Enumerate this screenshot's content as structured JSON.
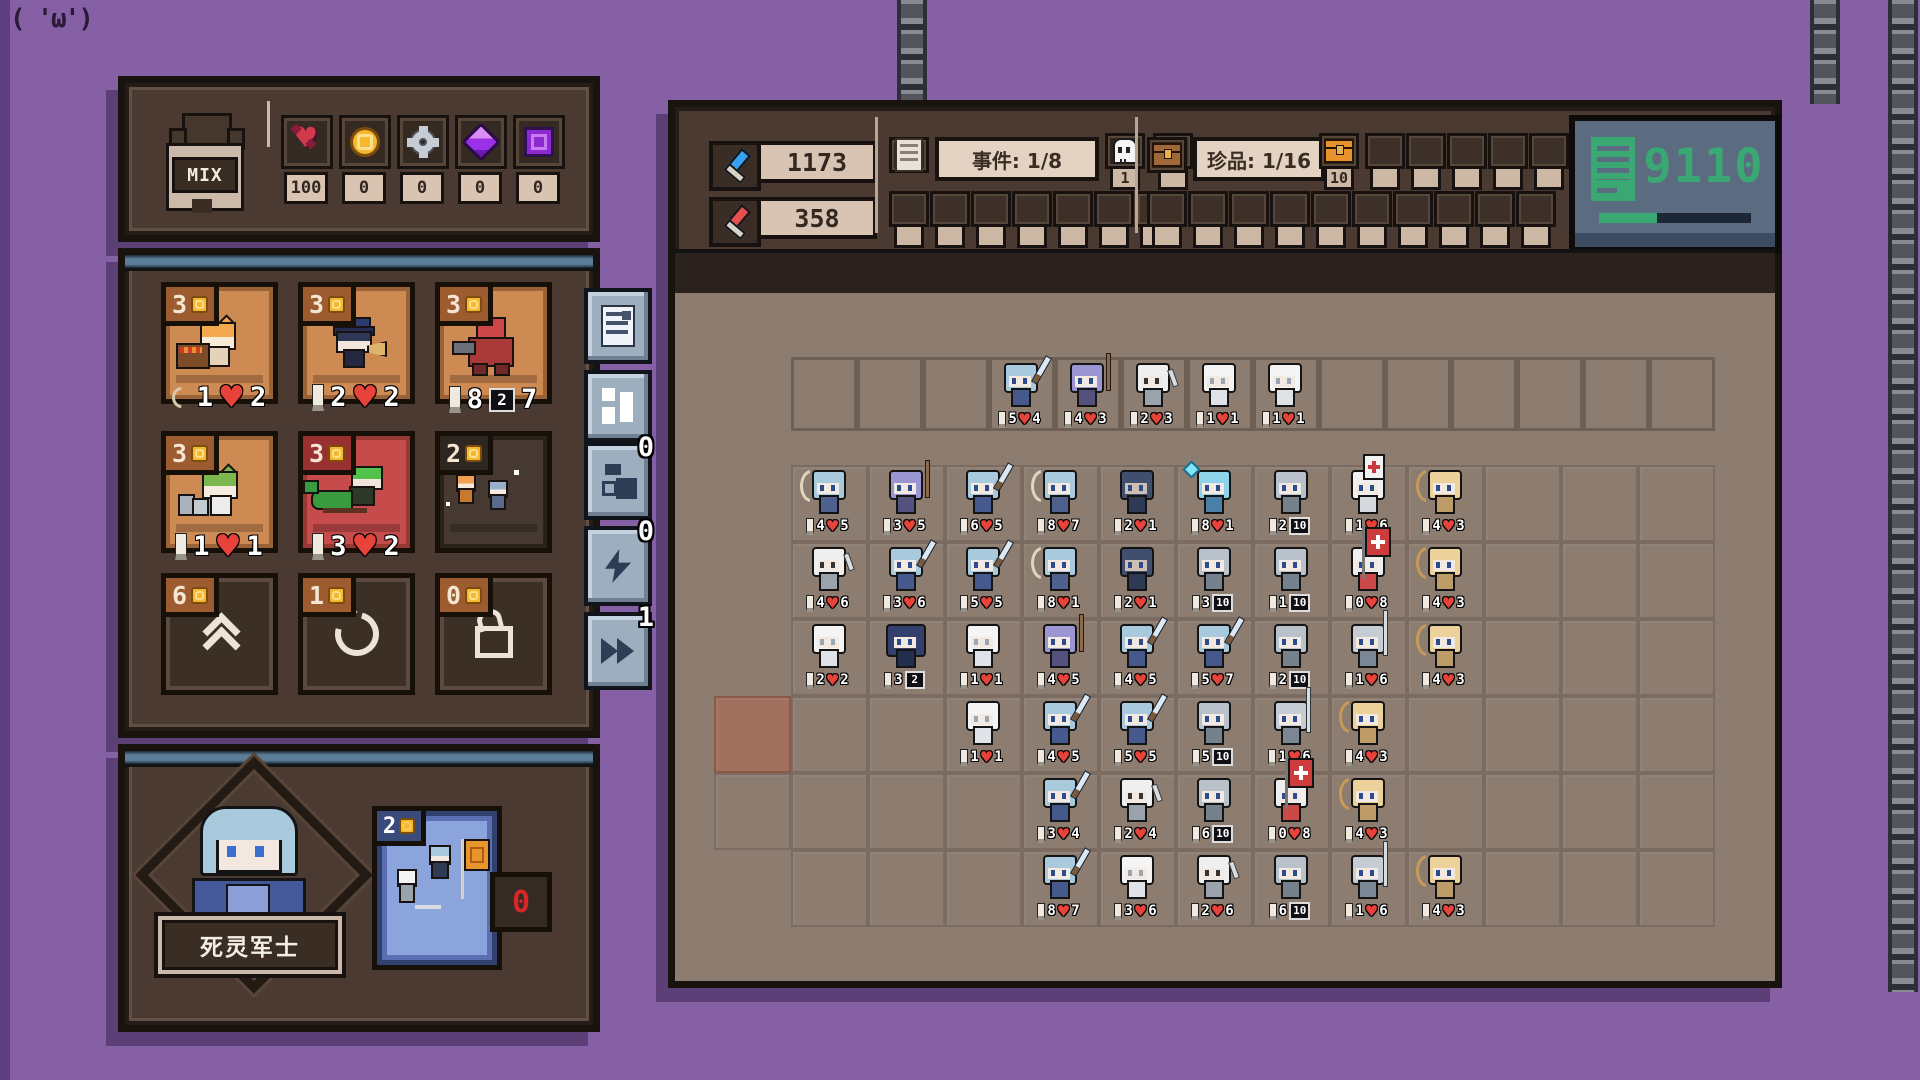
{
  "decoration": {
    "kaomoji": "( 'ω')"
  },
  "left_panel": {
    "base_label": "MIX",
    "currencies": [
      {
        "icon": "demon-heart",
        "value": "100"
      },
      {
        "icon": "coin",
        "value": "0"
      },
      {
        "icon": "gear",
        "value": "0"
      },
      {
        "icon": "gem",
        "value": "0"
      },
      {
        "icon": "cube",
        "value": "0"
      }
    ],
    "shop": {
      "cards": [
        {
          "cost": "3",
          "sprite": "orange-cat-shopkeeper",
          "stats": [
            [
              "bow",
              "1"
            ],
            [
              "heart",
              "2"
            ]
          ]
        },
        {
          "cost": "3",
          "sprite": "police-girl",
          "stats": [
            [
              "candle",
              "2"
            ],
            [
              "heart",
              "2"
            ]
          ]
        },
        {
          "cost": "3",
          "sprite": "red-mech",
          "stats": [
            [
              "candle",
              "8"
            ],
            [
              "shield",
              "2"
            ],
            [
              "plain",
              "7"
            ]
          ]
        },
        {
          "cost": "3",
          "sprite": "green-cat-girl",
          "stats": [
            [
              "candle",
              "1"
            ],
            [
              "heart",
              "1"
            ]
          ]
        },
        {
          "cost": "3",
          "sprite": "dragon-girl",
          "stats": [
            [
              "candle",
              "3"
            ],
            [
              "heart",
              "2"
            ]
          ]
        },
        {
          "cost": "2",
          "sprite": "duo-unit",
          "stats": []
        }
      ],
      "buttons": [
        {
          "cost": "6",
          "icon": "upgrade"
        },
        {
          "cost": "1",
          "icon": "refresh"
        },
        {
          "cost": "0",
          "icon": "lock"
        }
      ]
    },
    "hero": {
      "name": "死灵军士",
      "skill_cost": "2",
      "skill_counter": "0"
    }
  },
  "side_buttons": [
    {
      "icon": "document",
      "badge": ""
    },
    {
      "icon": "grid",
      "badge": ""
    },
    {
      "icon": "squares",
      "badge": "0"
    },
    {
      "icon": "lightning",
      "badge": "0"
    },
    {
      "icon": "fast-forward",
      "badge": "1"
    }
  ],
  "right_panel": {
    "blue_power": "1173",
    "red_power": "358",
    "events_label": "事件: 1/8",
    "skull_count": "1",
    "event_top_empty": 1,
    "event_bottom_slots": 7,
    "treasure_label": "珍品: 1/16",
    "chest_count": "10",
    "treasure_top_slots": 6,
    "treasure_bottom_slots": 10,
    "counter": {
      "value": "9110",
      "progress": 38
    }
  },
  "battle": {
    "grid": {
      "rows": 6,
      "cols": 12,
      "enemy_cells": 14
    },
    "extra_cells": [
      {
        "r": 3,
        "c": -1,
        "hl": true
      },
      {
        "r": 4,
        "c": -1,
        "hl": false
      }
    ],
    "enemy_units": [
      {
        "t": "blue",
        "s": [
          [
            "a",
            "5"
          ],
          [
            "h",
            "4"
          ]
        ]
      },
      {
        "t": "purple",
        "s": [
          [
            "a",
            "4"
          ],
          [
            "h",
            "3"
          ]
        ]
      },
      {
        "t": "skel",
        "s": [
          [
            "a",
            "2"
          ],
          [
            "h",
            "3"
          ]
        ]
      },
      {
        "t": "ghost",
        "s": [
          [
            "a",
            "1"
          ],
          [
            "h",
            "1"
          ]
        ]
      },
      {
        "t": "ghost",
        "s": [
          [
            "a",
            "1"
          ],
          [
            "h",
            "1"
          ]
        ]
      }
    ],
    "units": [
      {
        "r": 0,
        "c": 0,
        "t": "bluearcher",
        "s": [
          [
            "a",
            "4"
          ],
          [
            "h",
            "5"
          ]
        ]
      },
      {
        "r": 0,
        "c": 1,
        "t": "purple",
        "s": [
          [
            "a",
            "3"
          ],
          [
            "h",
            "5"
          ]
        ]
      },
      {
        "r": 0,
        "c": 2,
        "t": "blue",
        "s": [
          [
            "a",
            "6"
          ],
          [
            "h",
            "5"
          ]
        ]
      },
      {
        "r": 0,
        "c": 3,
        "t": "bluearcher",
        "s": [
          [
            "a",
            "8"
          ],
          [
            "h",
            "7"
          ]
        ]
      },
      {
        "r": 0,
        "c": 4,
        "t": "hood",
        "s": [
          [
            "a",
            "2"
          ],
          [
            "h",
            "1"
          ]
        ]
      },
      {
        "r": 0,
        "c": 5,
        "t": "ice",
        "s": [
          [
            "a",
            "8"
          ],
          [
            "h",
            "1"
          ]
        ]
      },
      {
        "r": 0,
        "c": 6,
        "t": "knight",
        "s": [
          [
            "a",
            "2"
          ],
          [
            "s",
            "10"
          ]
        ]
      },
      {
        "r": 0,
        "c": 7,
        "t": "medic",
        "s": [
          [
            "a",
            "1"
          ],
          [
            "h",
            "6"
          ]
        ]
      },
      {
        "r": 0,
        "c": 8,
        "t": "tan",
        "s": [
          [
            "a",
            "4"
          ],
          [
            "h",
            "3"
          ]
        ]
      },
      {
        "r": 1,
        "c": 0,
        "t": "skel",
        "s": [
          [
            "a",
            "4"
          ],
          [
            "h",
            "6"
          ]
        ]
      },
      {
        "r": 1,
        "c": 1,
        "t": "blue",
        "s": [
          [
            "a",
            "3"
          ],
          [
            "h",
            "6"
          ]
        ]
      },
      {
        "r": 1,
        "c": 2,
        "t": "blue",
        "s": [
          [
            "a",
            "5"
          ],
          [
            "h",
            "5"
          ]
        ]
      },
      {
        "r": 1,
        "c": 3,
        "t": "bluearcher",
        "s": [
          [
            "a",
            "8"
          ],
          [
            "h",
            "1"
          ]
        ]
      },
      {
        "r": 1,
        "c": 4,
        "t": "hood",
        "s": [
          [
            "a",
            "2"
          ],
          [
            "h",
            "1"
          ]
        ]
      },
      {
        "r": 1,
        "c": 5,
        "t": "knight",
        "s": [
          [
            "a",
            "3"
          ],
          [
            "s",
            "10"
          ]
        ]
      },
      {
        "r": 1,
        "c": 6,
        "t": "knight",
        "s": [
          [
            "a",
            "1"
          ],
          [
            "s",
            "10"
          ]
        ]
      },
      {
        "r": 1,
        "c": 7,
        "t": "banner",
        "s": [
          [
            "a",
            "0"
          ],
          [
            "h",
            "8"
          ]
        ]
      },
      {
        "r": 1,
        "c": 8,
        "t": "tan",
        "s": [
          [
            "a",
            "4"
          ],
          [
            "h",
            "3"
          ]
        ]
      },
      {
        "r": 2,
        "c": 0,
        "t": "ghost",
        "s": [
          [
            "a",
            "2"
          ],
          [
            "h",
            "2"
          ]
        ]
      },
      {
        "r": 2,
        "c": 1,
        "t": "bigknight",
        "s": [
          [
            "a",
            "3"
          ],
          [
            "s",
            "2"
          ]
        ]
      },
      {
        "r": 2,
        "c": 2,
        "t": "ghost",
        "s": [
          [
            "a",
            "1"
          ],
          [
            "h",
            "1"
          ]
        ]
      },
      {
        "r": 2,
        "c": 3,
        "t": "purple",
        "s": [
          [
            "a",
            "4"
          ],
          [
            "h",
            "5"
          ]
        ]
      },
      {
        "r": 2,
        "c": 4,
        "t": "blue",
        "s": [
          [
            "a",
            "4"
          ],
          [
            "h",
            "5"
          ]
        ]
      },
      {
        "r": 2,
        "c": 5,
        "t": "blue",
        "s": [
          [
            "a",
            "5"
          ],
          [
            "h",
            "7"
          ]
        ]
      },
      {
        "r": 2,
        "c": 6,
        "t": "knight",
        "s": [
          [
            "a",
            "2"
          ],
          [
            "s",
            "10"
          ]
        ]
      },
      {
        "r": 2,
        "c": 7,
        "t": "spear",
        "s": [
          [
            "a",
            "1"
          ],
          [
            "h",
            "6"
          ]
        ]
      },
      {
        "r": 2,
        "c": 8,
        "t": "tan",
        "s": [
          [
            "a",
            "4"
          ],
          [
            "h",
            "3"
          ]
        ]
      },
      {
        "r": 3,
        "c": 2,
        "t": "ghost",
        "s": [
          [
            "a",
            "1"
          ],
          [
            "h",
            "1"
          ]
        ]
      },
      {
        "r": 3,
        "c": 3,
        "t": "blue",
        "s": [
          [
            "a",
            "4"
          ],
          [
            "h",
            "5"
          ]
        ]
      },
      {
        "r": 3,
        "c": 4,
        "t": "blue",
        "s": [
          [
            "a",
            "5"
          ],
          [
            "h",
            "5"
          ]
        ]
      },
      {
        "r": 3,
        "c": 5,
        "t": "knight",
        "s": [
          [
            "a",
            "5"
          ],
          [
            "s",
            "10"
          ]
        ]
      },
      {
        "r": 3,
        "c": 6,
        "t": "spear",
        "s": [
          [
            "a",
            "1"
          ],
          [
            "h",
            "6"
          ]
        ]
      },
      {
        "r": 3,
        "c": 7,
        "t": "tan",
        "s": [
          [
            "a",
            "4"
          ],
          [
            "h",
            "3"
          ]
        ]
      },
      {
        "r": 4,
        "c": 3,
        "t": "blue",
        "s": [
          [
            "a",
            "3"
          ],
          [
            "h",
            "4"
          ]
        ]
      },
      {
        "r": 4,
        "c": 4,
        "t": "skel",
        "s": [
          [
            "a",
            "2"
          ],
          [
            "h",
            "4"
          ]
        ]
      },
      {
        "r": 4,
        "c": 5,
        "t": "knight",
        "s": [
          [
            "a",
            "6"
          ],
          [
            "s",
            "10"
          ]
        ]
      },
      {
        "r": 4,
        "c": 6,
        "t": "banner",
        "s": [
          [
            "a",
            "0"
          ],
          [
            "h",
            "8"
          ]
        ]
      },
      {
        "r": 4,
        "c": 7,
        "t": "tan",
        "s": [
          [
            "a",
            "4"
          ],
          [
            "h",
            "3"
          ]
        ]
      },
      {
        "r": 5,
        "c": 3,
        "t": "blue",
        "s": [
          [
            "a",
            "8"
          ],
          [
            "h",
            "7"
          ]
        ]
      },
      {
        "r": 5,
        "c": 4,
        "t": "ghost",
        "s": [
          [
            "a",
            "3"
          ],
          [
            "h",
            "6"
          ]
        ]
      },
      {
        "r": 5,
        "c": 5,
        "t": "skel",
        "s": [
          [
            "a",
            "2"
          ],
          [
            "h",
            "6"
          ]
        ]
      },
      {
        "r": 5,
        "c": 6,
        "t": "knight",
        "s": [
          [
            "a",
            "6"
          ],
          [
            "s",
            "10"
          ]
        ]
      },
      {
        "r": 5,
        "c": 7,
        "t": "spear",
        "s": [
          [
            "a",
            "1"
          ],
          [
            "h",
            "6"
          ]
        ]
      },
      {
        "r": 5,
        "c": 8,
        "t": "tan",
        "s": [
          [
            "a",
            "4"
          ],
          [
            "h",
            "3"
          ]
        ]
      }
    ]
  }
}
